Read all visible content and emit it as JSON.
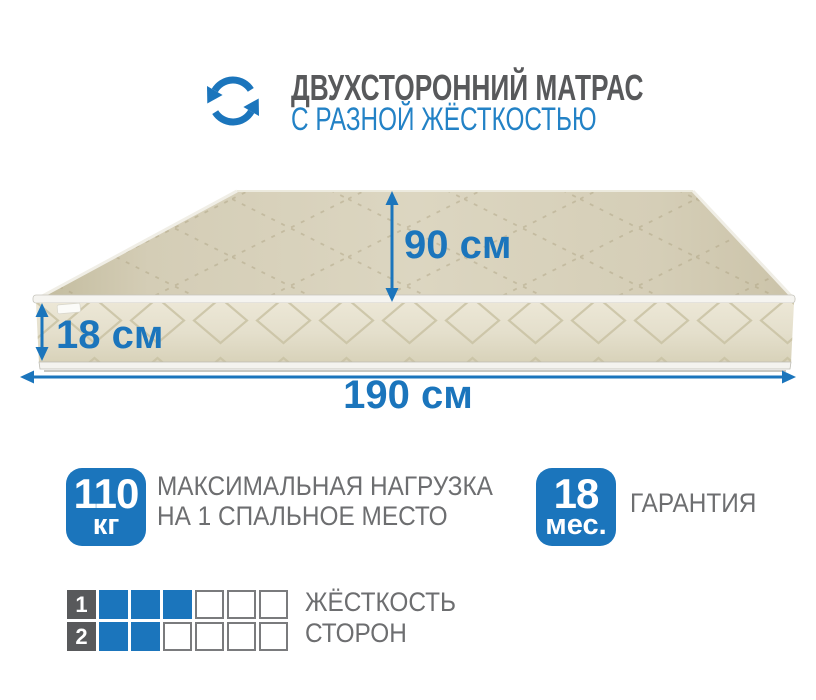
{
  "header": {
    "title": "ДВУХСТОРОННИЙ МАТРАС",
    "subtitle": "С РАЗНОЙ ЖЁСТКОСТЬЮ",
    "icon": "rotate-arrows-icon"
  },
  "dimensions": {
    "width_label": "90 см",
    "height_label": "18 см",
    "length_label": "190 см"
  },
  "features": [
    {
      "badge_value": "110",
      "badge_unit": "кг",
      "label_line1": "МАКСИМАЛЬНАЯ НАГРУЗКА",
      "label_line2": "НА 1 СПАЛЬНОЕ МЕСТО"
    },
    {
      "badge_value": "18",
      "badge_unit": "мес.",
      "label_line1": "ГАРАНТИЯ"
    }
  ],
  "firmness": {
    "label_line1": "ЖЁСТКОСТЬ",
    "label_line2": "СТОРОН",
    "scale_max": 6,
    "rows": [
      {
        "side": "1",
        "filled": 3
      },
      {
        "side": "2",
        "filled": 2
      }
    ]
  },
  "colors": {
    "accent_blue": "#1b75bc",
    "subtitle_blue": "#2382c6",
    "title_gray": "#58595b",
    "text_gray": "#6d6e70",
    "mattress_beige": "#d8d2bc"
  }
}
